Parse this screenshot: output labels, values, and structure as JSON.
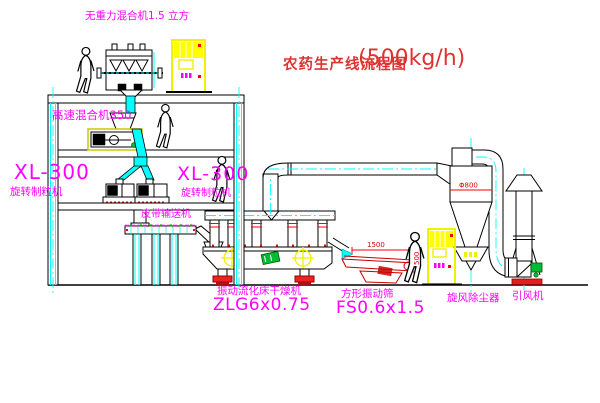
{
  "title": {
    "text": "农药生产线流程图",
    "capacity": "(500kg/h)"
  },
  "equipment_labels": {
    "gravity_free_mixer": "无重力混合机1.5 立方",
    "high_speed_mixer": "高速混合机350",
    "granulator_left": {
      "model": "XL-300",
      "name": "旋转制粒机"
    },
    "granulator_right": {
      "model": "XL-300",
      "name": "旋转制粒机"
    },
    "belt_conveyor": "皮带输送机",
    "fluid_bed_dryer": {
      "name": "振动流化床干燥机",
      "model": "ZLG6x0.75"
    },
    "vibrating_screen": {
      "name": "方形振动筛",
      "model": "FS0.6x1.5"
    },
    "cyclone": "旋风除尘器",
    "induced_draft_fan": "引风机"
  },
  "dimensions": {
    "cyclone_diameter": "Φ800",
    "screen_length": "1500",
    "screen_width": "500"
  },
  "colors": {
    "background": "#ffffff",
    "line_black": "#000000",
    "centerline_cyan": "#00ffff",
    "label_magenta": "#ff00ff",
    "title_red": "#dd3333",
    "cabinet_yellow": "#ffff00",
    "motor_green": "#00bb33",
    "accent_red": "#ff0000",
    "screen_dark_red": "#c80000"
  }
}
